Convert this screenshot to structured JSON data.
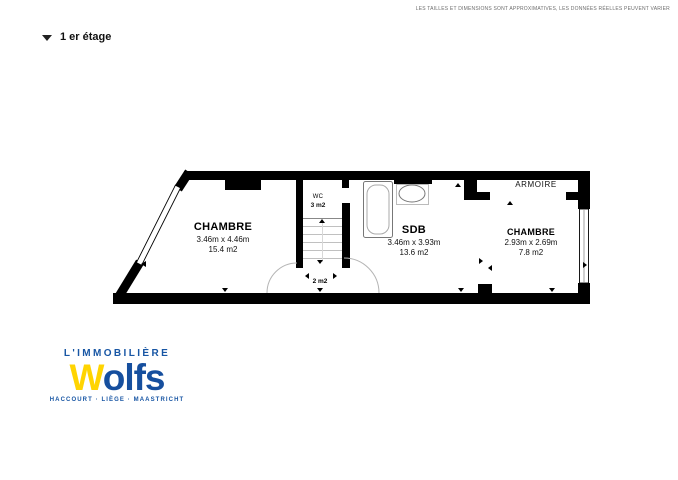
{
  "header": {
    "disclaimer": "LES TAILLES ET DIMENSIONS SONT APPROXIMATIVES, LES DONNÉES RÉELLES PEUVENT VARIER",
    "floor_title": "1 er étage"
  },
  "floor_plan": {
    "rooms": {
      "chambre1": {
        "name": "CHAMBRE",
        "dimensions": "3.46m x 4.46m",
        "area": "15.4 m2"
      },
      "wc": {
        "name": "WC",
        "area": "3 m2"
      },
      "sdb": {
        "name": "SDB",
        "dimensions": "3.46m x 3.93m",
        "area": "13.6 m2"
      },
      "chambre2": {
        "name": "CHAMBRE",
        "dimensions": "2.93m x 2.69m",
        "area": "7.8 m2"
      },
      "armoire": {
        "name": "ARMOIRE"
      },
      "hall": {
        "area": "2 m2"
      }
    }
  },
  "logo": {
    "tagline": "L'IMMOBILIÈRE",
    "brand_initial": "W",
    "brand_rest": "olfs",
    "cities": "HACCOURT · LIÈGE · MAASTRICHT"
  },
  "colors": {
    "brand_blue": "#1856A4",
    "brand_yellow": "#FFD401",
    "wall_black": "#000000"
  }
}
